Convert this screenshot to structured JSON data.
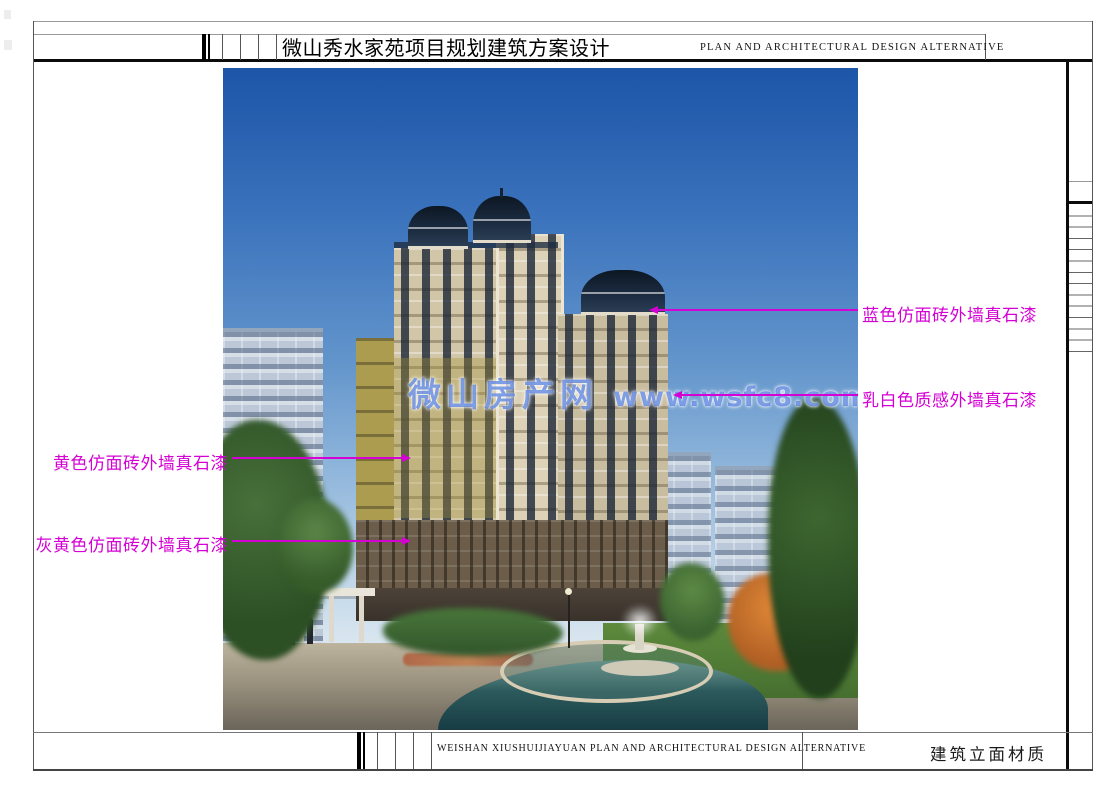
{
  "header": {
    "title_cn": "微山秀水家苑项目规划建筑方案设计",
    "title_en": "PLAN AND ARCHITECTURAL DESIGN ALTERNATIVE"
  },
  "footer": {
    "project_en": "WEISHAN XIUSHUIJIAYUAN PLAN AND ARCHITECTURAL DESIGN ALTERNATIVE",
    "sheet_title_cn": "建筑立面材质"
  },
  "annotations": {
    "color": "#d400d4",
    "right": [
      {
        "label": "蓝色仿面砖外墙真石漆"
      },
      {
        "label": "乳白色质感外墙真石漆"
      }
    ],
    "left": [
      {
        "label": "黄色仿面砖外墙真石漆"
      },
      {
        "label": "灰黄色仿面砖外墙真石漆"
      }
    ]
  },
  "watermark": {
    "site_name": "微山房产网",
    "url": "www.wsfc8.com",
    "color": "rgba(50,100,215,0.62)"
  }
}
